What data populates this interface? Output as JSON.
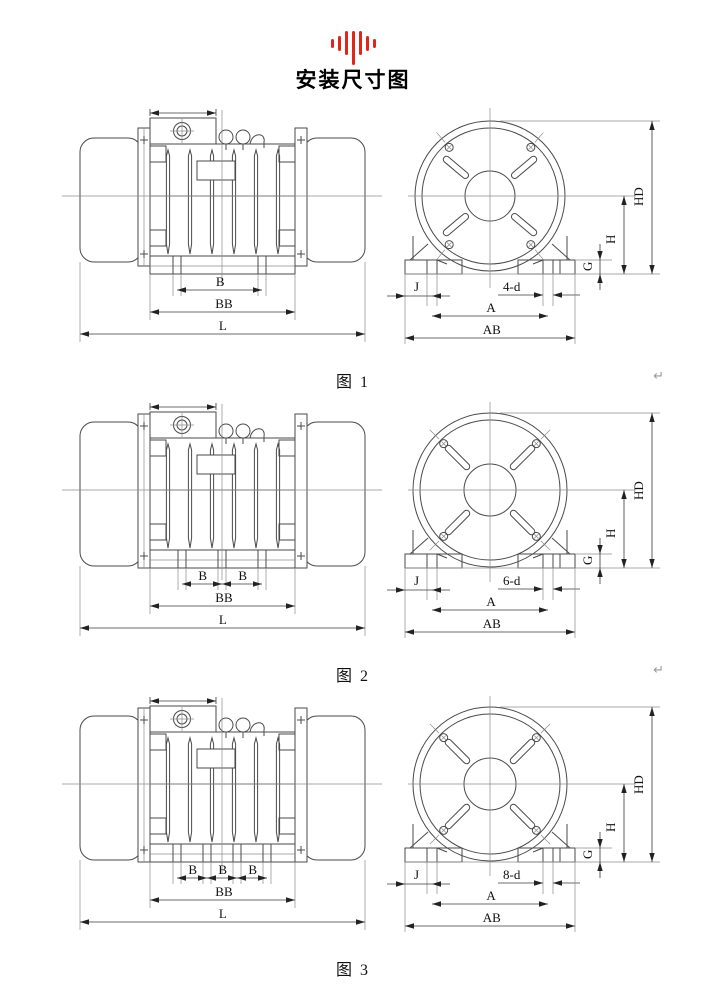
{
  "title": "安装尺寸图",
  "logo": {
    "icon": "soundwave-icon",
    "color": "#e0251b",
    "bar_heights": [
      9,
      15,
      24,
      34,
      24,
      15,
      9
    ]
  },
  "dims": {
    "b": "B",
    "bb": "BB",
    "l": "L",
    "j": "J",
    "a": "A",
    "ab": "AB",
    "hd": "HD",
    "h": "H",
    "g": "G"
  },
  "figures": [
    {
      "caption": "图  1",
      "number": "1",
      "holes_label": "4-d",
      "foot_bolts": 2,
      "pilcrow": "↵"
    },
    {
      "caption": "图  2",
      "number": "2",
      "holes_label": "6-d",
      "foot_bolts": 3,
      "pilcrow": "↵"
    },
    {
      "caption": "图  3",
      "number": "3",
      "holes_label": "8-d",
      "foot_bolts": 4,
      "pilcrow": ""
    }
  ]
}
